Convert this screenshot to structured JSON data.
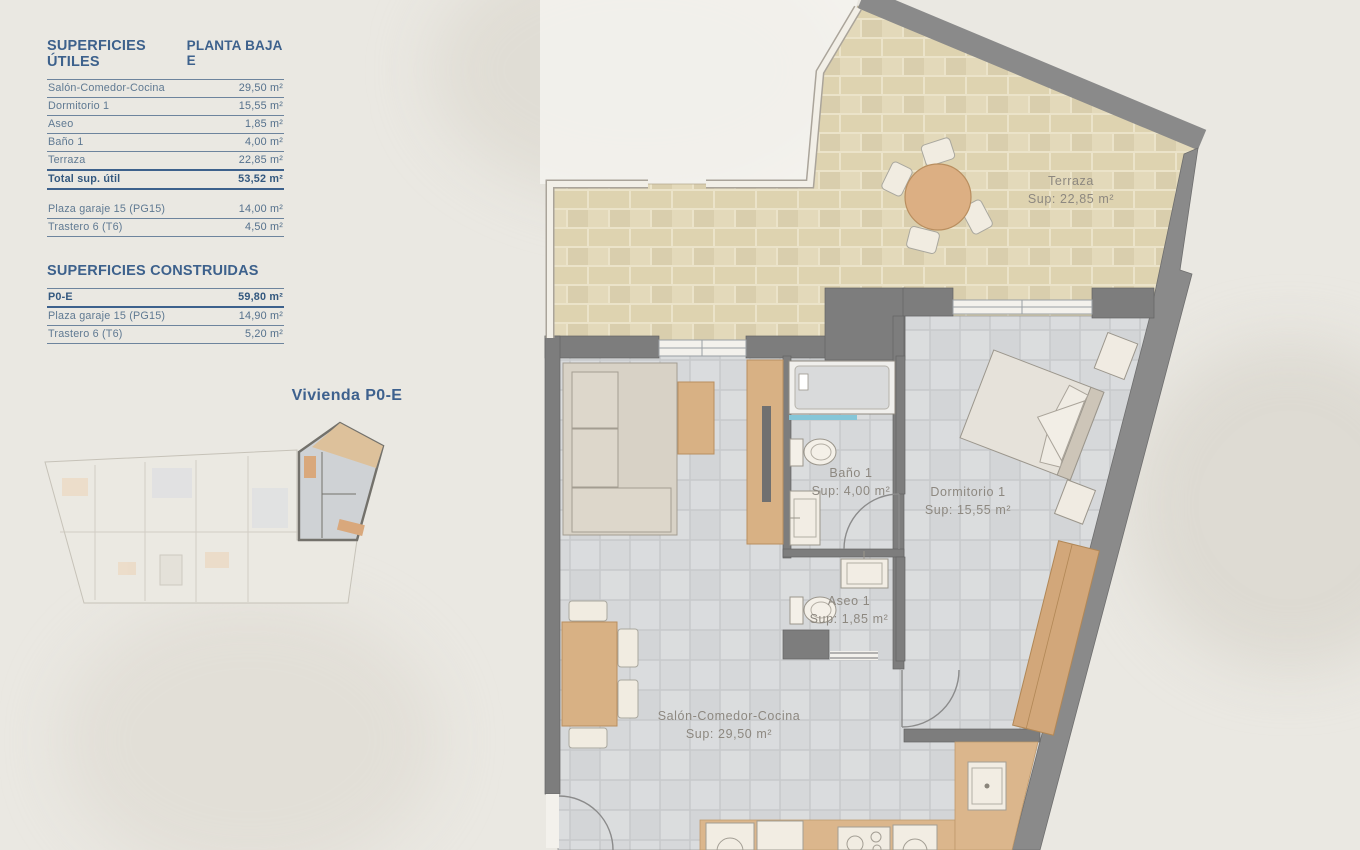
{
  "panel": {
    "utiles": {
      "title": "SUPERFICIES ÚTILES",
      "plan_label": "PLANTA BAJA E",
      "rows": [
        {
          "label": "Salón-Comedor-Cocina",
          "value": "29,50 m²"
        },
        {
          "label": "Dormitorio 1",
          "value": "15,55 m²"
        },
        {
          "label": "Aseo",
          "value": "1,85 m²"
        },
        {
          "label": "Baño 1",
          "value": "4,00 m²"
        },
        {
          "label": "Terraza",
          "value": "22,85 m²"
        }
      ],
      "total": {
        "label": "Total sup. útil",
        "value": "53,52 m²"
      },
      "extras": [
        {
          "label": "Plaza garaje 15 (PG15)",
          "value": "14,00 m²"
        },
        {
          "label": "Trastero 6 (T6)",
          "value": "4,50 m²"
        }
      ]
    },
    "construidas": {
      "title": "SUPERFICIES CONSTRUIDAS",
      "rows": [
        {
          "label": "P0-E",
          "value": "59,80 m²"
        },
        {
          "label": "Plaza garaje 15 (PG15)",
          "value": "14,90 m²"
        },
        {
          "label": "Trastero 6 (T6)",
          "value": "5,20 m²"
        }
      ]
    }
  },
  "overview": {
    "title": "Vivienda P0-E"
  },
  "floorplan": {
    "rooms": [
      {
        "name": "Terraza",
        "area": "Sup: 22,85 m²"
      },
      {
        "name": "Baño 1",
        "area": "Sup: 4,00 m²"
      },
      {
        "name": "Dormitorio 1",
        "area": "Sup: 15,55 m²"
      },
      {
        "name": "Aseo 1",
        "area": "Sup: 1,85 m²"
      },
      {
        "name": "Salón-Comedor-Cocina",
        "area": "Sup: 29,50 m²"
      }
    ]
  },
  "colors": {
    "accent_blue": "#3d618c",
    "wall_gray": "#7d7d7d",
    "wood": "#d2a77a",
    "terrace_brick": "#ded3b0",
    "floor_tile": "#d7d8da",
    "background": "#eae8e2"
  }
}
